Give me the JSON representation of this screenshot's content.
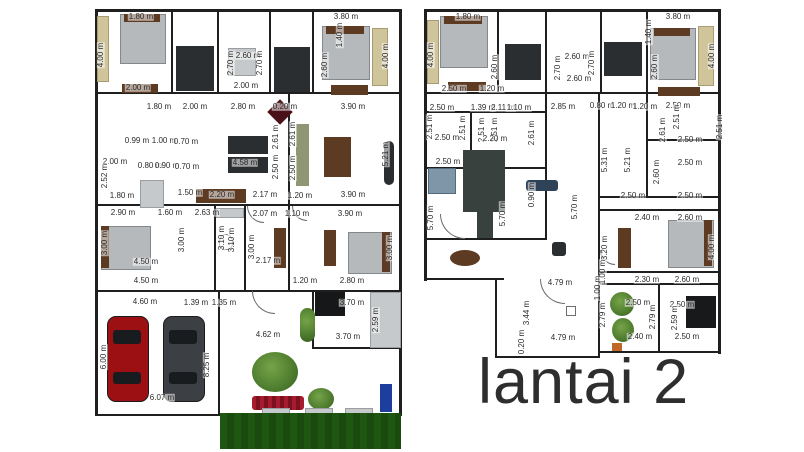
{
  "title": {
    "text": "lantai 2"
  },
  "colors": {
    "wall": "#1f1f1f",
    "ink": "#2b2b2b",
    "ink2": "#2e2e2e",
    "bed": "#b6b9bc",
    "dark": "#2b2e30",
    "wood": "#5d3a22",
    "tan": "#cfc49a",
    "olive": "#8f9674",
    "stairs": "#39413e",
    "grass": "#1e5711",
    "tree": "#4e7d2e",
    "flower": "#a81a2e",
    "carred": "#9c1014",
    "cargray": "#3c4044",
    "blue": "#1e3e9f"
  },
  "left_plan": {
    "labels": [
      {
        "t": "1.80 m",
        "x": 141,
        "y": 17
      },
      {
        "t": "4.00 m",
        "x": 101,
        "y": 55,
        "v": 1
      },
      {
        "t": "2.00 m",
        "x": 138,
        "y": 88
      },
      {
        "t": "2.60 m",
        "x": 248,
        "y": 56
      },
      {
        "t": "2.70 m",
        "x": 231,
        "y": 63,
        "v": 1
      },
      {
        "t": "2.70 m",
        "x": 260,
        "y": 63,
        "v": 1
      },
      {
        "t": "2.00 m",
        "x": 246,
        "y": 86
      },
      {
        "t": "3.80 m",
        "x": 346,
        "y": 17
      },
      {
        "t": "1.40 m",
        "x": 340,
        "y": 35,
        "v": 1
      },
      {
        "t": "2.60 m",
        "x": 325,
        "y": 65,
        "v": 1
      },
      {
        "t": "4.00 m",
        "x": 386,
        "y": 56,
        "v": 1
      },
      {
        "t": "1.80 m",
        "x": 159,
        "y": 107
      },
      {
        "t": "2.00 m",
        "x": 195,
        "y": 107
      },
      {
        "t": "2.80 m",
        "x": 243,
        "y": 107
      },
      {
        "t": "0.20 m",
        "x": 285,
        "y": 107
      },
      {
        "t": "3.90 m",
        "x": 353,
        "y": 107
      },
      {
        "t": "2.61 m",
        "x": 276,
        "y": 137,
        "v": 1
      },
      {
        "t": "2.61 m",
        "x": 293,
        "y": 134,
        "v": 1
      },
      {
        "t": "0.99 m",
        "x": 137,
        "y": 141
      },
      {
        "t": "1.00 m",
        "x": 164,
        "y": 141
      },
      {
        "t": "0.70 m",
        "x": 186,
        "y": 142
      },
      {
        "t": "2.00 m",
        "x": 115,
        "y": 162
      },
      {
        "t": "0.80 m",
        "x": 150,
        "y": 166
      },
      {
        "t": "0.90 m",
        "x": 167,
        "y": 166
      },
      {
        "t": "0.70 m",
        "x": 187,
        "y": 167
      },
      {
        "t": "4.58 m",
        "x": 245,
        "y": 163
      },
      {
        "t": "2.52 m",
        "x": 105,
        "y": 176,
        "v": 1
      },
      {
        "t": "2.50 m",
        "x": 276,
        "y": 167,
        "v": 1
      },
      {
        "t": "2.50 m",
        "x": 293,
        "y": 168,
        "v": 1
      },
      {
        "t": "1.80 m",
        "x": 122,
        "y": 196
      },
      {
        "t": "1.50 m",
        "x": 190,
        "y": 193
      },
      {
        "t": "2.20 m",
        "x": 222,
        "y": 195
      },
      {
        "t": "2.17 m",
        "x": 265,
        "y": 195
      },
      {
        "t": "1.20 m",
        "x": 300,
        "y": 196
      },
      {
        "t": "3.90 m",
        "x": 353,
        "y": 195
      },
      {
        "t": "5.21 m",
        "x": 386,
        "y": 154,
        "v": 1
      },
      {
        "t": "2.90 m",
        "x": 123,
        "y": 213
      },
      {
        "t": "1.60 m",
        "x": 170,
        "y": 213
      },
      {
        "t": "2.63 m",
        "x": 207,
        "y": 213
      },
      {
        "t": "2.07 m",
        "x": 265,
        "y": 214
      },
      {
        "t": "1.10 m",
        "x": 297,
        "y": 214
      },
      {
        "t": "3.90 m",
        "x": 350,
        "y": 214
      },
      {
        "t": "3.00 m",
        "x": 105,
        "y": 243,
        "v": 1
      },
      {
        "t": "3.00 m",
        "x": 182,
        "y": 240,
        "v": 1
      },
      {
        "t": "3.10 m",
        "x": 222,
        "y": 238,
        "v": 1
      },
      {
        "t": "3.10 m",
        "x": 232,
        "y": 240,
        "v": 1
      },
      {
        "t": "3.00 m",
        "x": 252,
        "y": 247,
        "v": 1
      },
      {
        "t": "3.00 m",
        "x": 390,
        "y": 248,
        "v": 1
      },
      {
        "t": "4.50 m",
        "x": 146,
        "y": 262
      },
      {
        "t": "2.17 m",
        "x": 268,
        "y": 261
      },
      {
        "t": "4.50 m",
        "x": 146,
        "y": 281
      },
      {
        "t": "1.20 m",
        "x": 305,
        "y": 281
      },
      {
        "t": "2.80 m",
        "x": 352,
        "y": 281
      },
      {
        "t": "4.60 m",
        "x": 145,
        "y": 302
      },
      {
        "t": "1.39 m",
        "x": 196,
        "y": 303
      },
      {
        "t": "1.35 m",
        "x": 224,
        "y": 303
      },
      {
        "t": "3.70 m",
        "x": 352,
        "y": 303
      },
      {
        "t": "2.59 m",
        "x": 376,
        "y": 320,
        "v": 1
      },
      {
        "t": "3.70 m",
        "x": 348,
        "y": 337
      },
      {
        "t": "4.62 m",
        "x": 268,
        "y": 335
      },
      {
        "t": "6.00 m",
        "x": 104,
        "y": 357,
        "v": 1
      },
      {
        "t": "8.25 m",
        "x": 207,
        "y": 365,
        "v": 1
      },
      {
        "t": "6.07 m",
        "x": 162,
        "y": 398
      }
    ]
  },
  "right_plan": {
    "labels": [
      {
        "t": "1.80 m",
        "x": 468,
        "y": 17
      },
      {
        "t": "4.00 m",
        "x": 431,
        "y": 55,
        "v": 1
      },
      {
        "t": "3.80 m",
        "x": 678,
        "y": 17
      },
      {
        "t": "4.00 m",
        "x": 712,
        "y": 56,
        "v": 1
      },
      {
        "t": "2.60 m",
        "x": 495,
        "y": 67,
        "v": 1
      },
      {
        "t": "2.70 m",
        "x": 558,
        "y": 68,
        "v": 1
      },
      {
        "t": "2.60 m",
        "x": 577,
        "y": 57
      },
      {
        "t": "2.60 m",
        "x": 579,
        "y": 79
      },
      {
        "t": "2.70 m",
        "x": 592,
        "y": 63,
        "v": 1
      },
      {
        "t": "1.40 m",
        "x": 649,
        "y": 32,
        "v": 1
      },
      {
        "t": "2.60 m",
        "x": 655,
        "y": 67,
        "v": 1
      },
      {
        "t": "2.50 m",
        "x": 454,
        "y": 89
      },
      {
        "t": "1.20 m",
        "x": 492,
        "y": 89
      },
      {
        "t": "2.50 m",
        "x": 442,
        "y": 108
      },
      {
        "t": "1.39 m",
        "x": 483,
        "y": 108
      },
      {
        "t": "2.11 m",
        "x": 503,
        "y": 108
      },
      {
        "t": "1.10 m",
        "x": 519,
        "y": 108
      },
      {
        "t": "2.85 m",
        "x": 563,
        "y": 107
      },
      {
        "t": "0.80 m",
        "x": 602,
        "y": 106
      },
      {
        "t": "1.20 m",
        "x": 623,
        "y": 106
      },
      {
        "t": "1.20 m",
        "x": 645,
        "y": 107
      },
      {
        "t": "2.50 m",
        "x": 678,
        "y": 106
      },
      {
        "t": "2.51 m",
        "x": 430,
        "y": 127,
        "v": 1
      },
      {
        "t": "2.51 m",
        "x": 463,
        "y": 128,
        "v": 1
      },
      {
        "t": "2.51 m",
        "x": 482,
        "y": 130,
        "v": 1
      },
      {
        "t": "2.51 m",
        "x": 495,
        "y": 130,
        "v": 1
      },
      {
        "t": "2.61 m",
        "x": 532,
        "y": 133,
        "v": 1
      },
      {
        "t": "2.61 m",
        "x": 663,
        "y": 130,
        "v": 1
      },
      {
        "t": "2.51 m",
        "x": 677,
        "y": 117,
        "v": 1
      },
      {
        "t": "2.51 m",
        "x": 720,
        "y": 127,
        "v": 1
      },
      {
        "t": "2.50 m",
        "x": 447,
        "y": 138
      },
      {
        "t": "2.20 m",
        "x": 495,
        "y": 139
      },
      {
        "t": "2.50 m",
        "x": 448,
        "y": 162
      },
      {
        "t": "5.31 m",
        "x": 605,
        "y": 160,
        "v": 1
      },
      {
        "t": "5.21 m",
        "x": 628,
        "y": 160,
        "v": 1
      },
      {
        "t": "2.60 m",
        "x": 657,
        "y": 172,
        "v": 1
      },
      {
        "t": "2.50 m",
        "x": 690,
        "y": 140
      },
      {
        "t": "2.50 m",
        "x": 690,
        "y": 163
      },
      {
        "t": "2.50 m",
        "x": 633,
        "y": 196
      },
      {
        "t": "2.50 m",
        "x": 690,
        "y": 196
      },
      {
        "t": "5.70 m",
        "x": 431,
        "y": 218,
        "v": 1
      },
      {
        "t": "5.70 m",
        "x": 503,
        "y": 214,
        "v": 1
      },
      {
        "t": "5.70 m",
        "x": 575,
        "y": 207,
        "v": 1
      },
      {
        "t": "0.90 m",
        "x": 532,
        "y": 195,
        "v": 1
      },
      {
        "t": "4.79 m",
        "x": 560,
        "y": 283
      },
      {
        "t": "1.00 m",
        "x": 598,
        "y": 288,
        "v": 1
      },
      {
        "t": "3.44 m",
        "x": 527,
        "y": 313,
        "v": 1
      },
      {
        "t": "2.79 m",
        "x": 603,
        "y": 315,
        "v": 1
      },
      {
        "t": "0.20 m",
        "x": 522,
        "y": 342,
        "v": 1
      },
      {
        "t": "4.79 m",
        "x": 563,
        "y": 338
      },
      {
        "t": "2.40 m",
        "x": 647,
        "y": 218
      },
      {
        "t": "2.60 m",
        "x": 690,
        "y": 218
      },
      {
        "t": "3.20 m",
        "x": 605,
        "y": 248,
        "v": 1
      },
      {
        "t": "4.00 m",
        "x": 712,
        "y": 247,
        "v": 1
      },
      {
        "t": "1.00 m",
        "x": 603,
        "y": 272,
        "v": 1
      },
      {
        "t": "2.30 m",
        "x": 647,
        "y": 280
      },
      {
        "t": "2.60 m",
        "x": 687,
        "y": 280
      },
      {
        "t": "2.50 m",
        "x": 638,
        "y": 303
      },
      {
        "t": "2.50 m",
        "x": 682,
        "y": 305
      },
      {
        "t": "2.79 m",
        "x": 653,
        "y": 317,
        "v": 1
      },
      {
        "t": "2.59 m",
        "x": 675,
        "y": 318,
        "v": 1
      },
      {
        "t": "2.40 m",
        "x": 640,
        "y": 337
      },
      {
        "t": "2.50 m",
        "x": 687,
        "y": 337
      }
    ]
  }
}
